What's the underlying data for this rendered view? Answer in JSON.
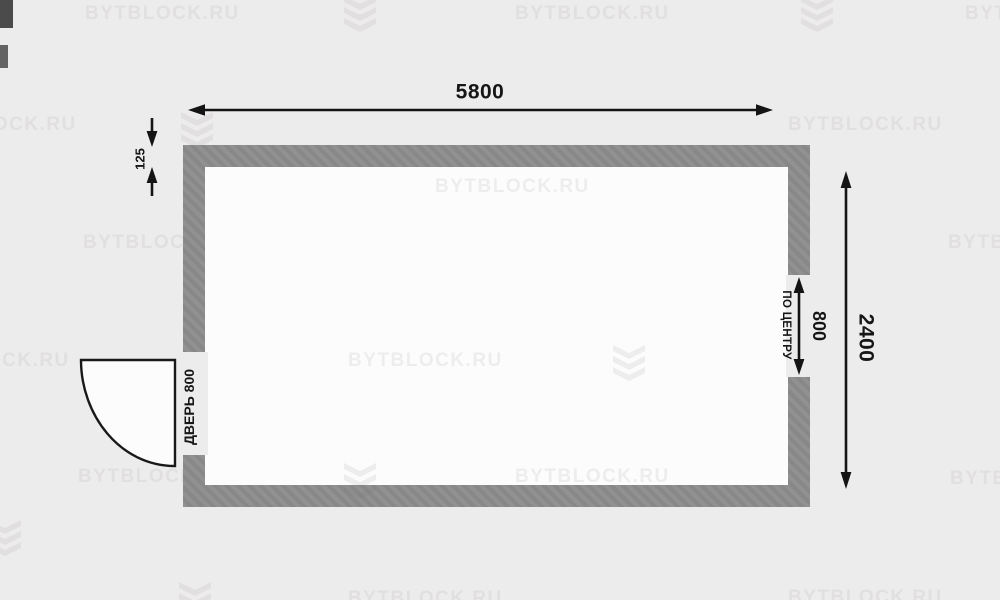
{
  "plan": {
    "overall_width": "5800",
    "overall_height": "2400",
    "wall_thickness": "125",
    "window_width": "800",
    "window_note": "ПО ЦЕНТРУ",
    "door": "ДВЕРЬ 800"
  },
  "watermark": {
    "text": "BYTBLOCK.RU"
  },
  "colors": {
    "background": "#edecec",
    "wall": "#8b8b8b",
    "room_interior": "#fcfcfc",
    "dimension_lines": "#141414"
  }
}
